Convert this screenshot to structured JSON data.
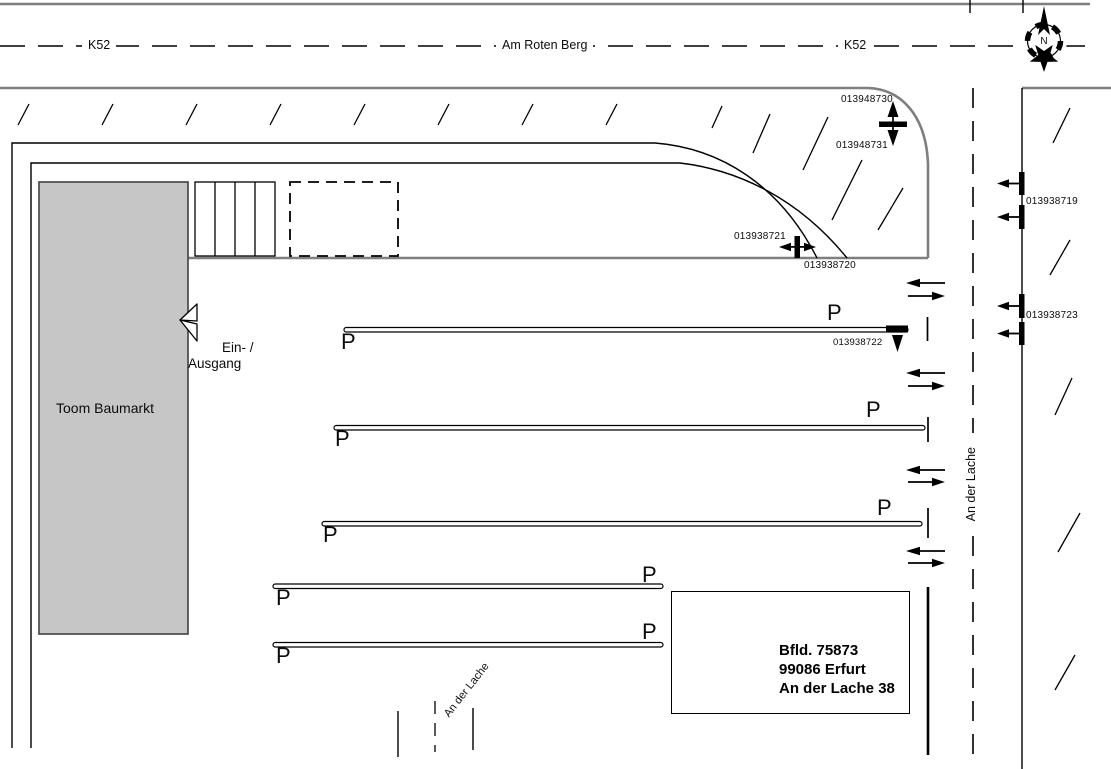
{
  "plan": {
    "streets": {
      "k52_left": "K52",
      "k52_right": "K52",
      "am_roten_berg": "Am Roten Berg",
      "an_der_lache_side": "An der Lache",
      "an_der_lache_bottom": "An der Lache"
    },
    "building_label": "Toom Baumarkt",
    "entrance": {
      "line1": "Ein- /",
      "line2": "Ausgang"
    },
    "address": {
      "line1": "Bfld. 75873",
      "line2": "99086 Erfurt",
      "line3": "An der Lache 38"
    },
    "parking_symbol": "P",
    "compass_north": "N",
    "survey_markers": {
      "m013948730": "013948730",
      "m013948731": "013948731",
      "m013938721": "013938721",
      "m013938720": "013938720",
      "m013938722": "013938722",
      "m013938719": "013938719",
      "m013938723": "013938723"
    },
    "colors": {
      "road_gray": "#7f7f7f",
      "building_fill": "#c6c6c6",
      "building_border": "#4a4a4a",
      "ink": "#000000"
    }
  }
}
